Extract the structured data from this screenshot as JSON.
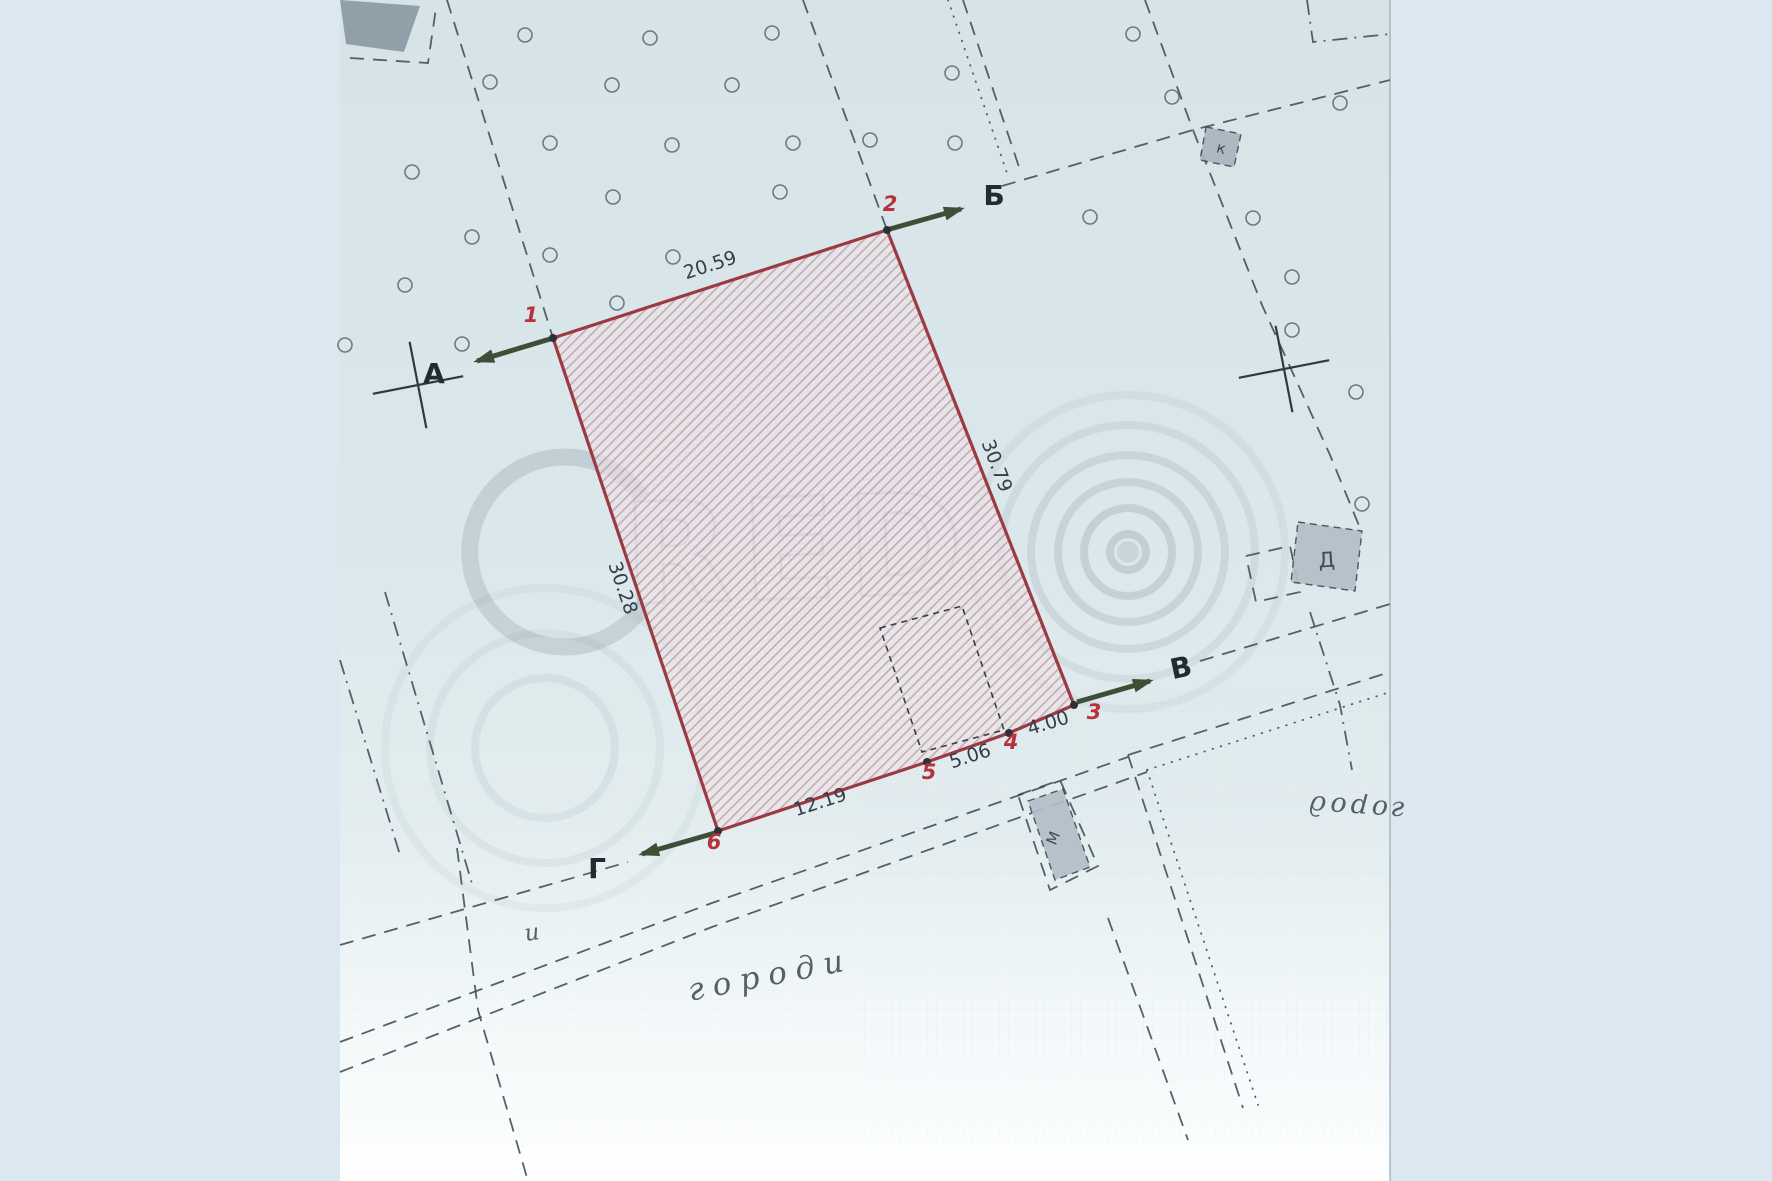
{
  "document": {
    "type": "Scanned cadastral site plan with highlighted land parcel",
    "language": "uk"
  },
  "colors": {
    "outer_bg": "#dbe8f2",
    "paper_mid": "#dae7eb",
    "ink": "#3e4c56",
    "parcel_border": "#9c3a43",
    "hatch_bg": "rgba(238,226,230,0.6)",
    "hatch_line": "rgba(158,104,114,0.5)",
    "vertex_red": "#b8323c",
    "vertex_dot": "#2b3338",
    "dim_text": "#333e47",
    "letter_text": "#222b31",
    "arrow_green": "#3d5037",
    "watermark": "#8797a0",
    "grid": "rgba(120,160,200,0.14)",
    "building_dark": "#8b99a3",
    "building_light": "#b3bfc8",
    "paper_edge": "rgba(148,163,173,0.55)"
  },
  "geometry": {
    "paper": {
      "x": 340,
      "w": 1050,
      "h": 1181
    },
    "crosshairs": [
      {
        "x": 418,
        "y": 385,
        "rot": -11
      },
      {
        "x": 1284,
        "y": 369,
        "rot": -11
      }
    ],
    "orchard_dots": [
      [
        525,
        35
      ],
      [
        650,
        38
      ],
      [
        772,
        33
      ],
      [
        1133,
        34
      ],
      [
        490,
        82
      ],
      [
        612,
        85
      ],
      [
        732,
        85
      ],
      [
        952,
        73
      ],
      [
        550,
        143
      ],
      [
        672,
        145
      ],
      [
        793,
        143
      ],
      [
        955,
        143
      ],
      [
        412,
        172
      ],
      [
        613,
        197
      ],
      [
        780,
        192
      ],
      [
        870,
        140
      ],
      [
        1172,
        97
      ],
      [
        1340,
        103
      ],
      [
        472,
        237
      ],
      [
        550,
        255
      ],
      [
        673,
        257
      ],
      [
        1090,
        217
      ],
      [
        1253,
        218
      ],
      [
        405,
        285
      ],
      [
        617,
        303
      ],
      [
        1292,
        277
      ],
      [
        345,
        345
      ],
      [
        462,
        344
      ],
      [
        1292,
        330
      ],
      [
        1356,
        392
      ],
      [
        1362,
        504
      ]
    ],
    "lines": [
      {
        "name": "boundary-line-nw",
        "style": "dash",
        "pts": [
          [
            447,
            0
          ],
          [
            553,
            338
          ]
        ]
      },
      {
        "name": "boundary-line-n",
        "style": "dash",
        "pts": [
          [
            803,
            0
          ],
          [
            887,
            230
          ]
        ]
      },
      {
        "name": "boundary-dotted-ne",
        "style": "dot",
        "pts": [
          [
            948,
            0
          ],
          [
            1008,
            176
          ]
        ]
      },
      {
        "name": "boundary-dash-ne",
        "style": "dash",
        "pts": [
          [
            963,
            0
          ],
          [
            1020,
            170
          ]
        ]
      },
      {
        "name": "street-line-b",
        "style": "dash",
        "pts": [
          [
            1002,
            186
          ],
          [
            1193,
            130
          ],
          [
            1390,
            80
          ]
        ]
      },
      {
        "name": "boundary-top-junction",
        "style": "dash",
        "pts": [
          [
            1145,
            0
          ],
          [
            1193,
            130
          ]
        ]
      },
      {
        "name": "boundary-right",
        "style": "dash",
        "pts": [
          [
            1193,
            130
          ],
          [
            1262,
            305
          ],
          [
            1330,
            455
          ],
          [
            1360,
            528
          ]
        ]
      },
      {
        "name": "street-line-v",
        "style": "dash",
        "pts": [
          [
            1200,
            661
          ],
          [
            1390,
            604
          ]
        ]
      },
      {
        "name": "road-edge-dash-e",
        "style": "dash",
        "pts": [
          [
            1128,
            755
          ],
          [
            1390,
            672
          ]
        ]
      },
      {
        "name": "road-edge-dot-e",
        "style": "dot",
        "pts": [
          [
            1147,
            770
          ],
          [
            1390,
            692
          ]
        ]
      },
      {
        "name": "road-edge-dash-s1",
        "style": "dash",
        "pts": [
          [
            1128,
            755
          ],
          [
            1243,
            1108
          ]
        ]
      },
      {
        "name": "road-edge-dot-s",
        "style": "dot",
        "pts": [
          [
            1147,
            770
          ],
          [
            1258,
            1105
          ]
        ]
      },
      {
        "name": "road-edge-dash-s2",
        "style": "dash",
        "pts": [
          [
            1108,
            918
          ],
          [
            1188,
            1140
          ]
        ]
      },
      {
        "name": "road-edge-mid",
        "style": "dash",
        "pts": [
          [
            340,
            1042
          ],
          [
            712,
            903
          ],
          [
            1128,
            757
          ]
        ]
      },
      {
        "name": "road-edge-low",
        "style": "dash",
        "pts": [
          [
            340,
            1072
          ],
          [
            712,
            927
          ],
          [
            1147,
            772
          ]
        ]
      },
      {
        "name": "street-line-g",
        "style": "dash",
        "pts": [
          [
            340,
            945
          ],
          [
            628,
            862
          ]
        ]
      },
      {
        "name": "boundary-sw-vertical",
        "style": "dash",
        "pts": [
          [
            457,
            848
          ],
          [
            478,
            1010
          ],
          [
            528,
            1181
          ]
        ]
      },
      {
        "name": "boundary-w-dashdot-1",
        "style": "dashdot",
        "pts": [
          [
            385,
            592
          ],
          [
            473,
            887
          ]
        ]
      },
      {
        "name": "boundary-w-dashdot-2",
        "style": "dashdot",
        "pts": [
          [
            340,
            660
          ],
          [
            400,
            855
          ]
        ]
      },
      {
        "name": "tl-building-dash",
        "style": "dash",
        "pts": [
          [
            350,
            58
          ],
          [
            428,
            63
          ],
          [
            436,
            8
          ]
        ]
      },
      {
        "name": "tr-corner-dash",
        "style": "dashdot",
        "pts": [
          [
            1307,
            0
          ],
          [
            1313,
            42
          ],
          [
            1390,
            34
          ]
        ]
      },
      {
        "name": "d-building-annex-dash",
        "style": "dash",
        "pts": [
          [
            1246,
            556
          ],
          [
            1290,
            546
          ],
          [
            1300,
            592
          ],
          [
            1256,
            602
          ],
          [
            1246,
            556
          ]
        ]
      },
      {
        "name": "d-building-lower-dash",
        "style": "dashdot",
        "pts": [
          [
            1310,
            612
          ],
          [
            1340,
            705
          ],
          [
            1352,
            770
          ]
        ]
      },
      {
        "name": "m-building-dash",
        "style": "dash",
        "pts": [
          [
            1018,
            795
          ],
          [
            1060,
            780
          ],
          [
            1098,
            866
          ],
          [
            1050,
            890
          ],
          [
            1018,
            795
          ]
        ]
      }
    ]
  },
  "parcel": {
    "border_color": "#9c3a43",
    "vertices": [
      {
        "label": "1",
        "x": 553,
        "y": 338,
        "lx": 531,
        "ly": 322
      },
      {
        "label": "2",
        "x": 887,
        "y": 230,
        "lx": 890,
        "ly": 211
      },
      {
        "label": "3",
        "x": 1074,
        "y": 705,
        "lx": 1094,
        "ly": 719
      },
      {
        "label": "4",
        "x": 1009,
        "y": 733,
        "lx": 1011,
        "ly": 749
      },
      {
        "label": "5",
        "x": 927,
        "y": 762,
        "lx": 929,
        "ly": 779
      },
      {
        "label": "6",
        "x": 718,
        "y": 831,
        "lx": 714,
        "ly": 849
      }
    ],
    "edges": [
      {
        "length": "20.59",
        "lx": 712,
        "ly": 271,
        "rot": -18
      },
      {
        "length": "30.79",
        "lx": 991,
        "ly": 468,
        "rot": 69
      },
      {
        "length": "4.00",
        "lx": 1050,
        "ly": 729,
        "rot": -17
      },
      {
        "length": "5.06",
        "lx": 972,
        "ly": 762,
        "rot": -18
      },
      {
        "length": "12.19",
        "lx": 822,
        "ly": 808,
        "rot": -18
      },
      {
        "length": "30.28",
        "lx": 617,
        "ly": 590,
        "rot": 71
      }
    ],
    "inner_building": [
      [
        880,
        628
      ],
      [
        962,
        606
      ],
      [
        1004,
        730
      ],
      [
        922,
        752
      ]
    ]
  },
  "directions": [
    {
      "letter": "А",
      "x1": 550,
      "y1": 339,
      "x2": 477,
      "y2": 361,
      "lx": 434,
      "ly": 383,
      "lrot": 0
    },
    {
      "letter": "Б",
      "x1": 890,
      "y1": 229,
      "x2": 961,
      "y2": 209,
      "lx": 994,
      "ly": 205,
      "lrot": 0
    },
    {
      "letter": "В",
      "x1": 1077,
      "y1": 702,
      "x2": 1150,
      "y2": 681,
      "lx": 1183,
      "ly": 677,
      "lrot": -12
    },
    {
      "letter": "Г",
      "x1": 715,
      "y1": 833,
      "x2": 642,
      "y2": 854,
      "lx": 597,
      "ly": 878,
      "lrot": 0
    }
  ],
  "buildings": [
    {
      "name": "building-topleft",
      "points": [
        [
          340,
          0
        ],
        [
          420,
          6
        ],
        [
          404,
          52
        ],
        [
          346,
          44
        ]
      ],
      "fill": "#8b99a3",
      "dashed": false,
      "label": ""
    },
    {
      "name": "building-k",
      "points": [
        [
          1206,
          127
        ],
        [
          1241,
          134
        ],
        [
          1234,
          167
        ],
        [
          1200,
          160
        ]
      ],
      "fill": "#a9b6c0",
      "dashed": true,
      "label": "к",
      "lx": 1220,
      "ly": 153,
      "lrot": 15,
      "lsize": 15
    },
    {
      "name": "building-d",
      "points": [
        [
          1298,
          522
        ],
        [
          1362,
          531
        ],
        [
          1355,
          591
        ],
        [
          1291,
          582
        ]
      ],
      "fill": "#b3bfc8",
      "dashed": true,
      "label": "Д",
      "lx": 1327,
      "ly": 567,
      "lrot": -4,
      "lsize": 21
    },
    {
      "name": "building-m",
      "points": [
        [
          1028,
          801
        ],
        [
          1063,
          789
        ],
        [
          1090,
          867
        ],
        [
          1055,
          880
        ]
      ],
      "fill": "#b3bfc8",
      "dashed": true,
      "label": "М",
      "lx": 1058,
      "ly": 840,
      "lrot": -68,
      "lsize": 15
    }
  ],
  "texts": [
    {
      "name": "garden-label-bottom",
      "text": "городи",
      "x": 772,
      "y": 985,
      "rot": -11,
      "size": 31,
      "cursive": true,
      "spacing": 9
    },
    {
      "name": "garden-label-right",
      "text": "город",
      "x": 1356,
      "y": 799,
      "rot": 184,
      "size": 27,
      "cursive": true,
      "spacing": 4
    },
    {
      "name": "annotation-i",
      "text": "и",
      "x": 533,
      "y": 940,
      "rot": -8,
      "size": 23,
      "cursive": true,
      "spacing": 0
    }
  ],
  "watermark": {
    "logo_text": "RED",
    "symbol_name": "copyright-rings",
    "c_circle": {
      "cx": 565,
      "cy": 552,
      "r": 95,
      "width": 17
    },
    "red_text": {
      "x": 800,
      "y": 598,
      "size": 140,
      "rot": -2
    },
    "rings": {
      "cx": 1128,
      "cy": 552,
      "radii": [
        18,
        44,
        70,
        97,
        127,
        157
      ]
    },
    "faint_rings": {
      "cx": 545,
      "cy": 748,
      "radii": [
        70,
        115,
        160
      ]
    }
  }
}
